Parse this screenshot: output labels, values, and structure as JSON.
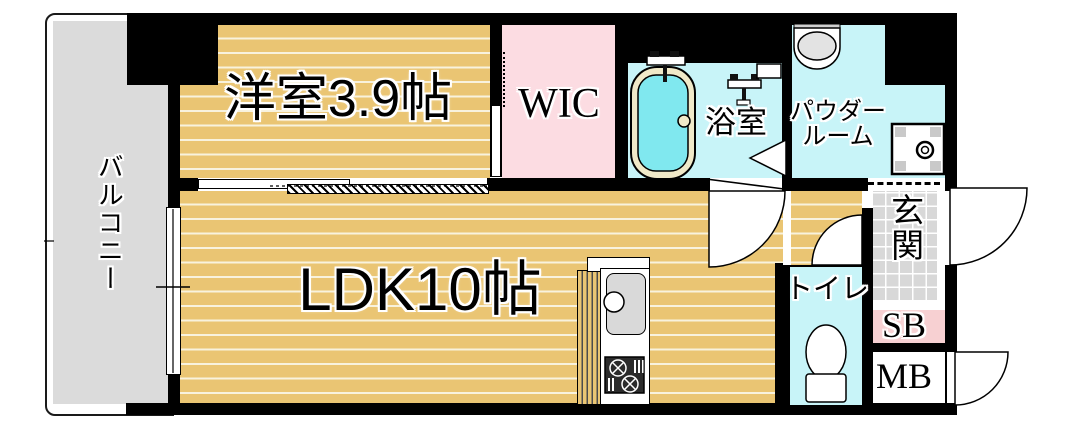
{
  "plan": {
    "title": "1LDK apartment floor plan",
    "rooms": {
      "western_room": {
        "label": "洋室3.9帖"
      },
      "wic": {
        "label": "WIC"
      },
      "bathroom": {
        "label": "浴室"
      },
      "powder_room": {
        "label_line1": "パウダー",
        "label_line2": "ルーム"
      },
      "ldk": {
        "label": "LDK10帖"
      },
      "toilet": {
        "label": "トイレ"
      },
      "entrance": {
        "label": "玄関"
      },
      "shoe_box": {
        "label": "SB"
      },
      "meter_box": {
        "label": "MB"
      },
      "balcony": {
        "label": "バルコニー"
      }
    },
    "colors": {
      "wall": "#000000",
      "wood_floor": "#eac573",
      "wood_stripe": "#f8f2dd",
      "wic_pink": "#fcdce2",
      "sb_pink": "#f7d0d2",
      "wet_area_cyan": "#c8f4f8",
      "bathtub_water": "#80e8ef",
      "bathtub_rim": "#f0e9c8",
      "balcony_gray": "#dbdbdb",
      "entrance_tile_gray": "#d8d8d8",
      "fixture_gray": "#d9d9d9"
    },
    "icons": {
      "bathtub": "oval tub with faucet",
      "shower-fixture": "wall faucet glyph",
      "washbasin": "half-round sink",
      "washer-pan": "square pan with drain",
      "toilet-bowl": "tank and bowl",
      "kitchen-sink": "counter sink with tap",
      "gas-stove": "2-burner grill",
      "door-arc": "quarter-circle swing",
      "sliding-door": "hatched panel"
    }
  }
}
